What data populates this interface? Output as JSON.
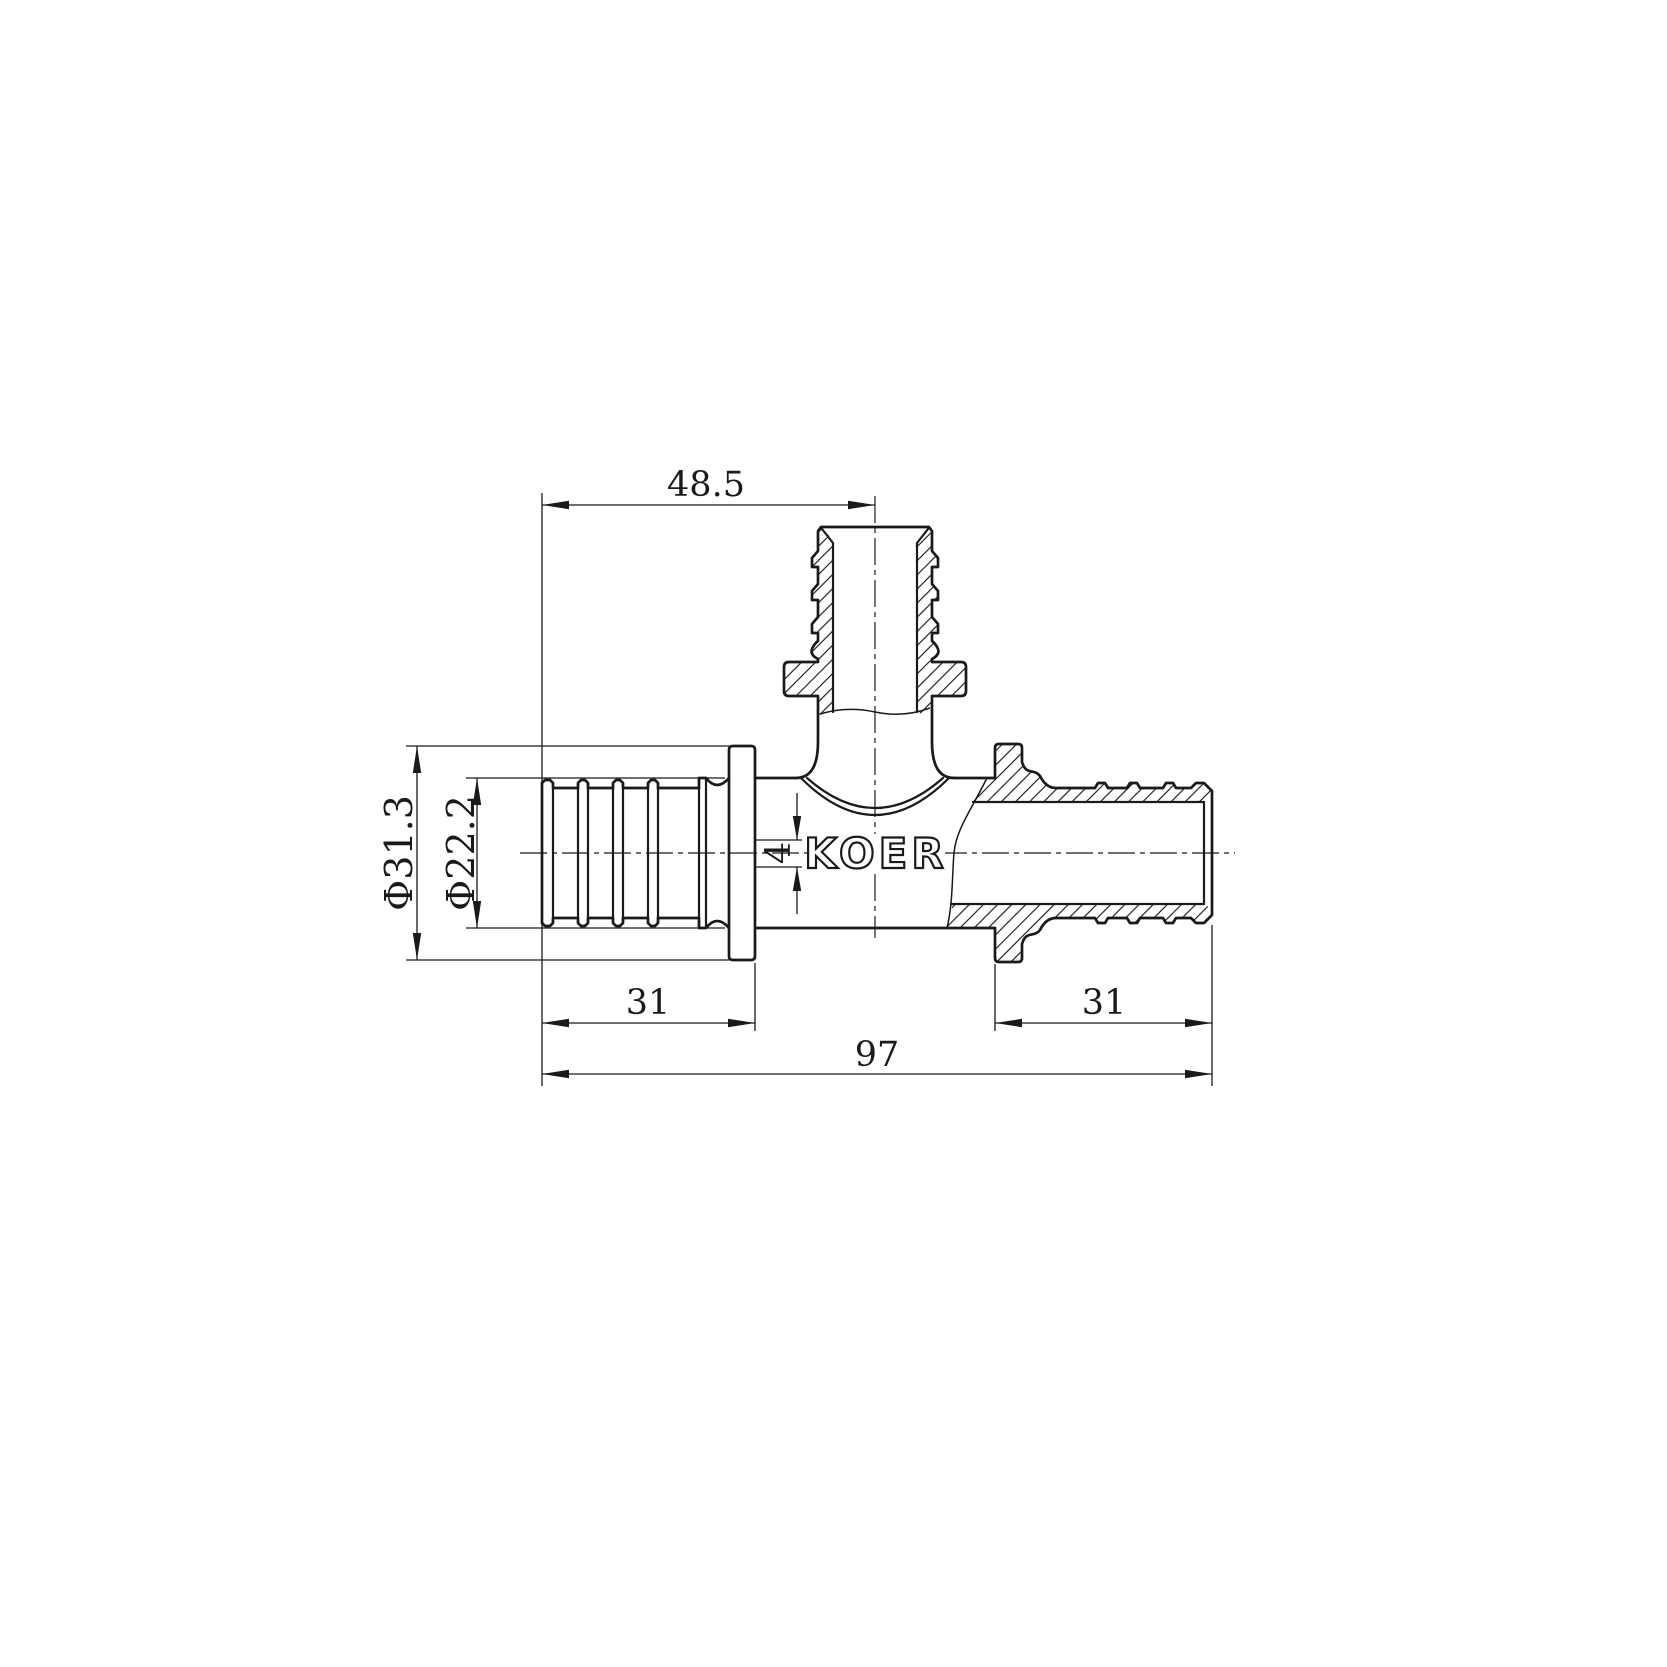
{
  "page": {
    "background": "#ffffff",
    "line_color": "#1a1a1a"
  },
  "drawing": {
    "logo_text": "KOER",
    "dimensions": {
      "branch_offset": "48.5",
      "outer_diameter_left": "Φ31.3",
      "barb_diameter_left": "Φ22.2",
      "pipe_stop_width": "4",
      "insert_length_left": "31",
      "insert_length_right": "31",
      "overall_length": "97"
    }
  }
}
